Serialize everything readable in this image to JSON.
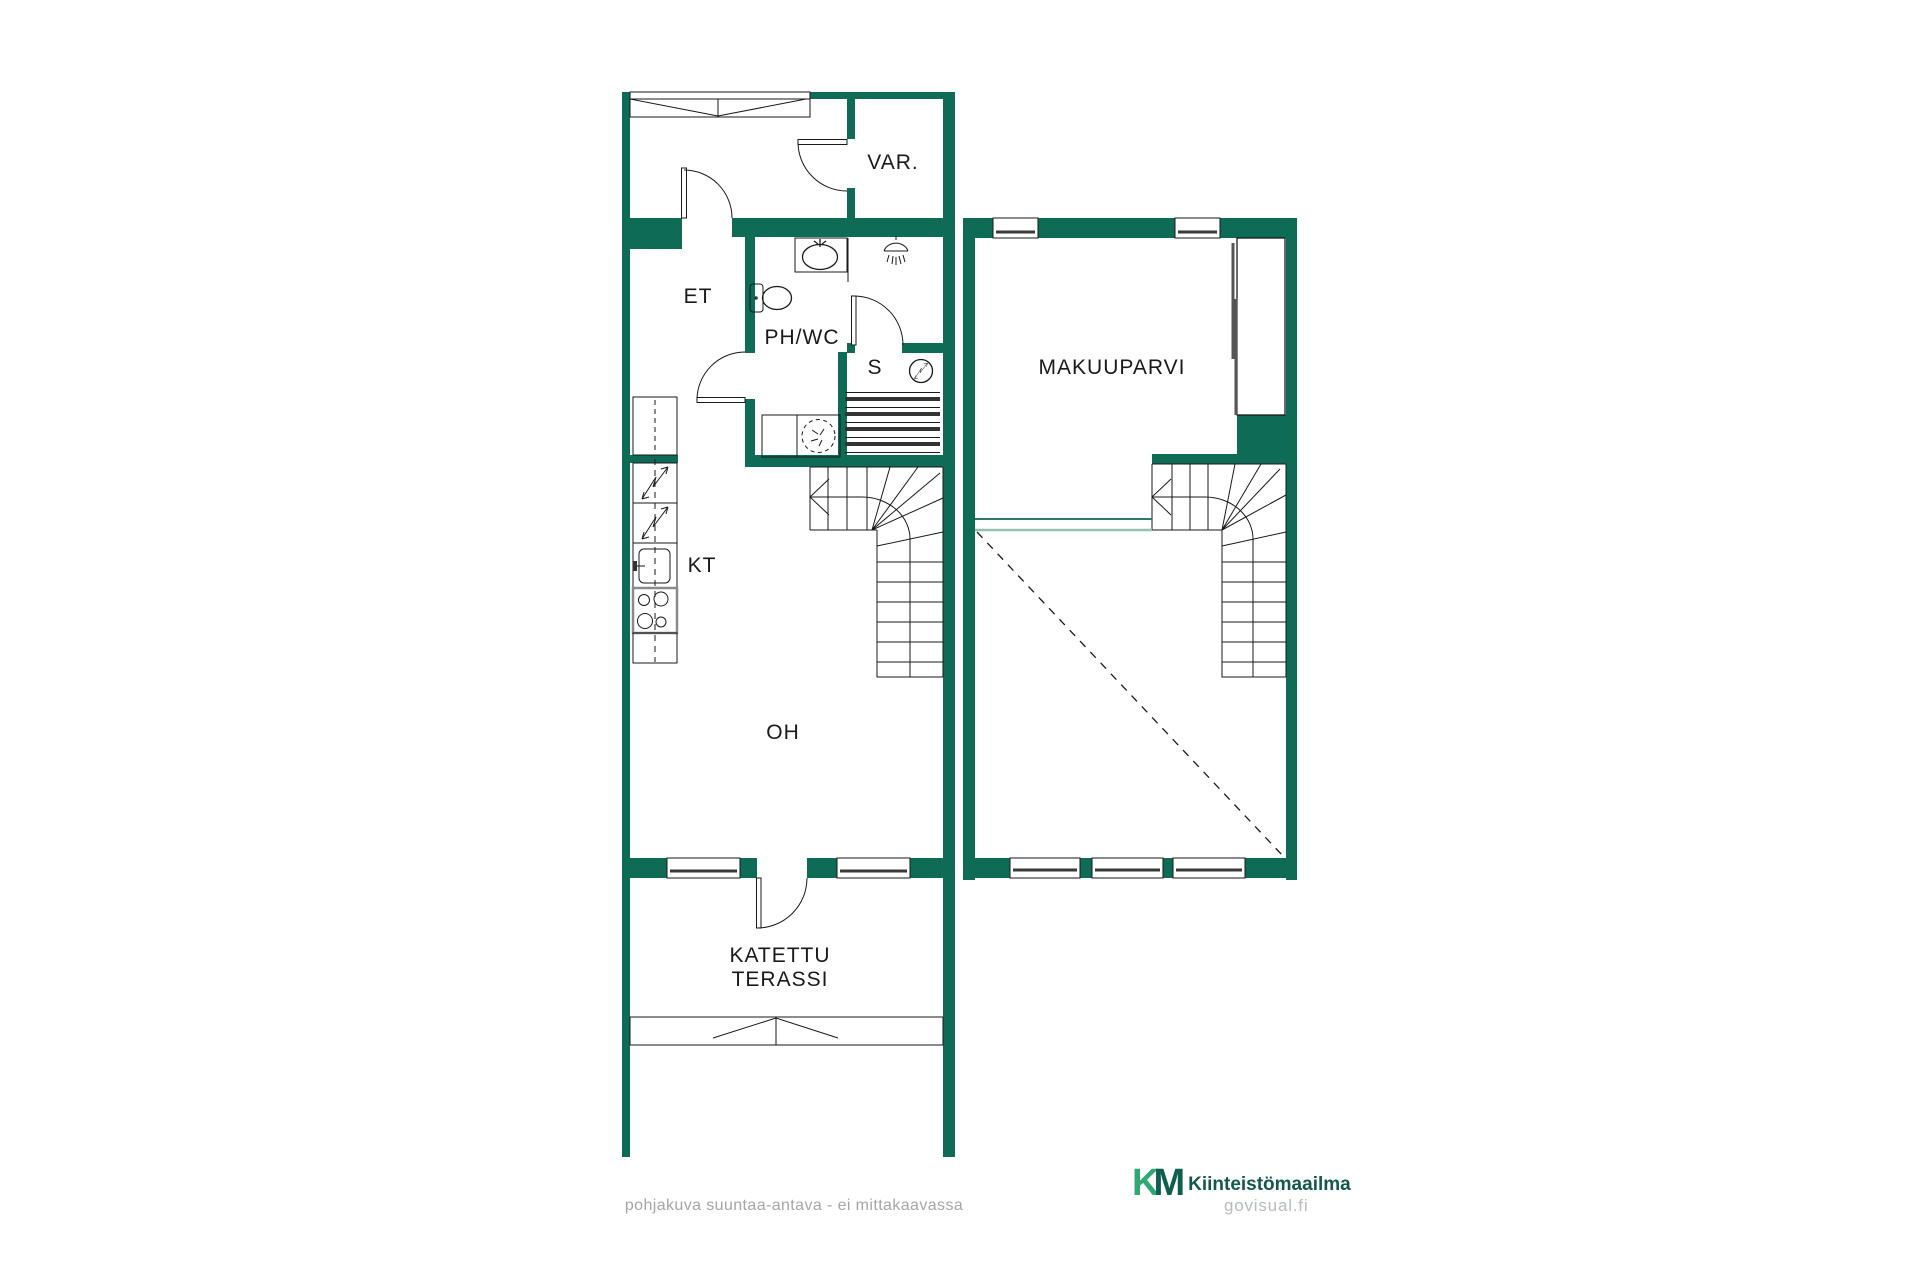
{
  "colors": {
    "wall": "#0e6b55",
    "line": "#1a1a1a",
    "sill": "#3a3a3a",
    "accent_dark": "#2b7a65",
    "accent_light": "#96c0b5",
    "muted": "#a6a6a6",
    "brand_light": "#2fa873",
    "brand_dark": "#0f5f4e",
    "brand_text": "#14594b",
    "watermark": "#b7bcbe"
  },
  "labels": {
    "storage": "VAR.",
    "entry": "ET",
    "bathroom": "PH/WC",
    "sauna": "S",
    "kitchen": "KT",
    "living": "OH",
    "terrace": "KATETTU TERASSI",
    "loft": "MAKUUPARVI"
  },
  "footer": {
    "disclaimer": "pohjakuva suuntaa-antava - ei mittakaavassa"
  },
  "brand": {
    "mark_k": "K",
    "mark_m": "M",
    "name": "Kiinteistömaailma",
    "watermark": "govisual.fi"
  }
}
